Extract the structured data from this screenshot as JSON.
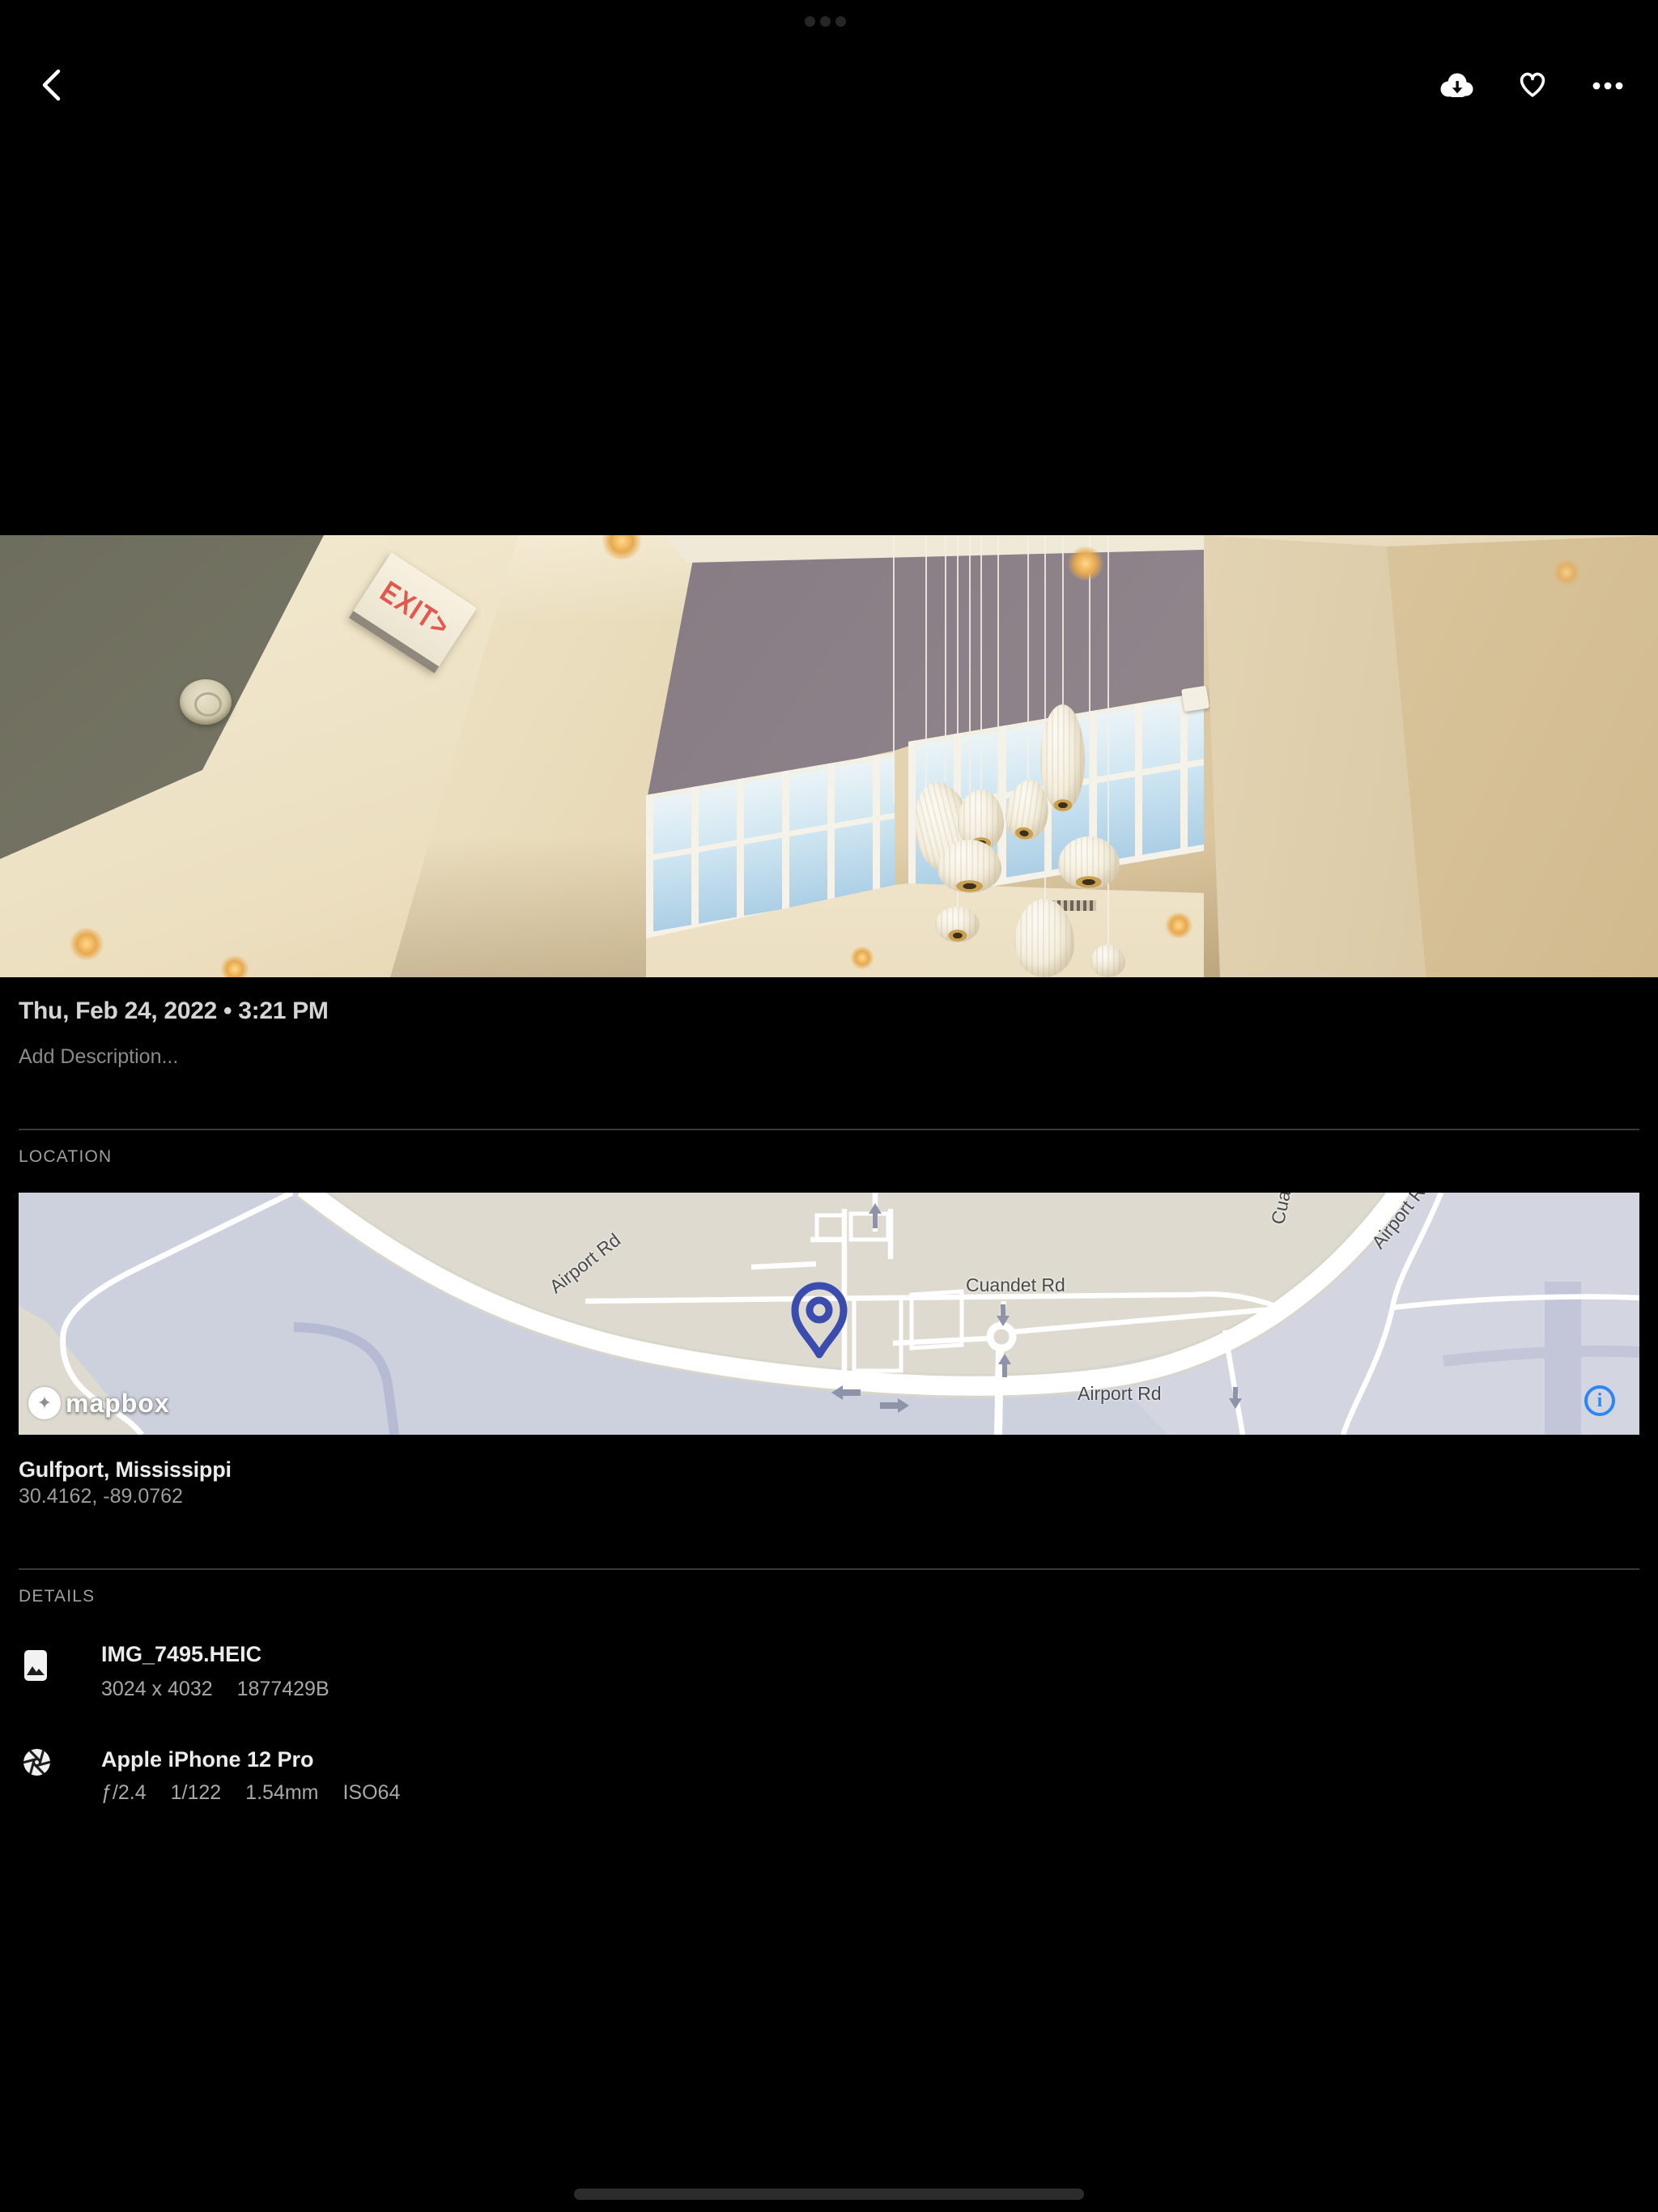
{
  "colors": {
    "background": "#000000",
    "pin_blue": "#3a4cae",
    "info_blue": "#2b87f5",
    "exit_red": "#e4574d",
    "map_land_beige": "#dedad0",
    "map_base_lavender": "#cdd1de",
    "map_secondary_road": "#b6bbd4"
  },
  "photo": {
    "exit_sign": "EXIT>"
  },
  "info": {
    "date": "Thu, Feb 24, 2022 • 3:21 PM",
    "description_placeholder": "Add Description..."
  },
  "location": {
    "header": "LOCATION",
    "place": "Gulfport, Mississippi",
    "coordinates": "30.4162, -89.0762",
    "map": {
      "labels": [
        {
          "text": "Airport Rd"
        },
        {
          "text": "Cuandet Rd"
        },
        {
          "text": "Airport Rd"
        },
        {
          "text": "Airport Rd"
        },
        {
          "text": "Cuandet Rd"
        }
      ],
      "attribution": "mapbox",
      "info_button": "i"
    }
  },
  "details": {
    "header": "DETAILS",
    "file": {
      "name": "IMG_7495.HEIC",
      "dimensions": "3024 x 4032",
      "size": "1877429B"
    },
    "camera": {
      "name": "Apple iPhone 12 Pro",
      "aperture": "ƒ/2.4",
      "shutter_speed": "1/122",
      "focal_length": "1.54mm",
      "iso": "ISO64"
    }
  }
}
